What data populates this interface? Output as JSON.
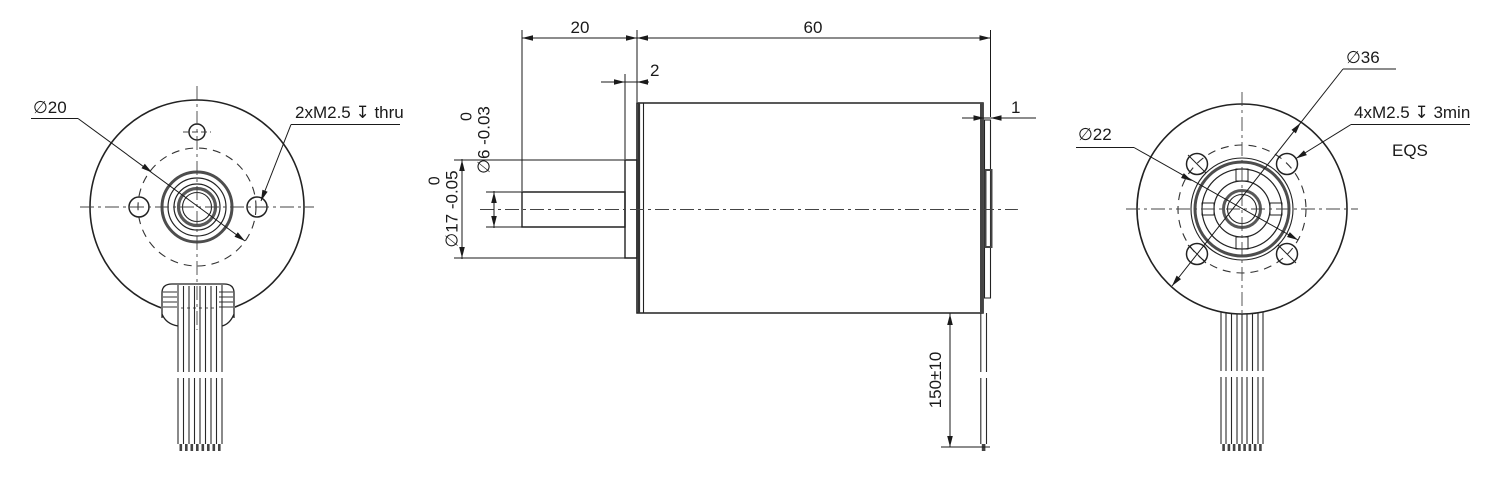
{
  "front_view": {
    "bolt_circle_dia": "∅20",
    "mount_holes": "2xM2.5 ↧ thru"
  },
  "side_view": {
    "shaft_length": "20",
    "body_length": "60",
    "boss_width": "2",
    "rear_cap_width": "1",
    "shaft_dia": {
      "upper": "0",
      "value": "∅6 -0.03"
    },
    "boss_dia": {
      "upper": "0",
      "value": "∅17 -0.05"
    },
    "cable_length": "150±10"
  },
  "rear_view": {
    "body_dia": "∅36",
    "mount_holes": "4xM2.5 ↧ 3min",
    "spacing_note": "EQS",
    "bolt_circle_dia": "∅22"
  }
}
